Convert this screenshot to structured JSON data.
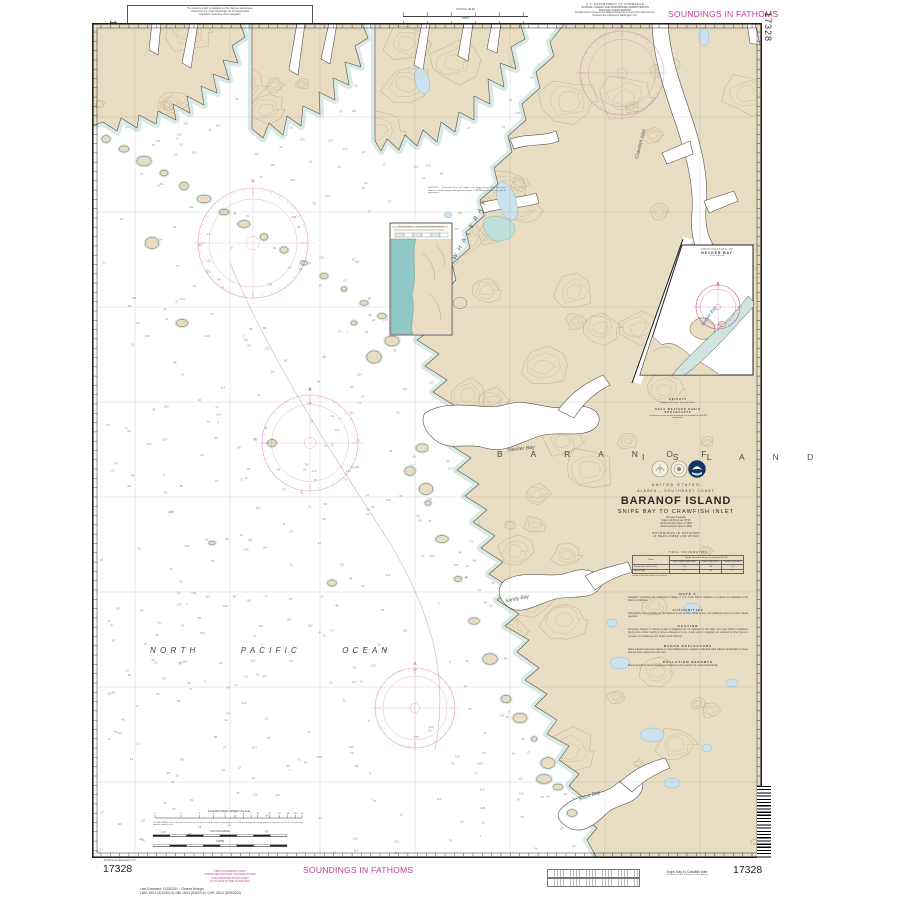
{
  "colors": {
    "magenta": "#c13e8e",
    "land": "#e8dcc2",
    "contour": "#ad9467",
    "shallow": "#d7e8e4",
    "lake": "#c9e2ee",
    "teal": "#8fc8c5",
    "sounding": "#6b7f8c"
  },
  "margin": {
    "note1": "The positions of aids to navigation on this chart are approximate.",
    "note2": "Consult the U.S. Coast Guard Light List for supplemental",
    "note3": "information concerning aids to navigation.",
    "auth1": "U.S. DEPARTMENT OF COMMERCE",
    "auth2": "NATIONAL OCEANIC AND ATMOSPHERIC ADMINISTRATION",
    "auth3": "NATIONAL OCEAN SERVICE",
    "auth4": "Compiled from surveys by the National Ocean Service and from other sources.",
    "auth5": "Prepared and published at Washington, D.C.",
    "soundings_top": "SOUNDINGS IN FATHOMS",
    "chart_number_vertical_left": "17328",
    "chart_number_vertical_right": "17328",
    "scale_caption_miles": "NAUTICAL MILES",
    "scale_caption_yards": "YARDS"
  },
  "title_block": {
    "mini_note_1_heading": "HEIGHTS",
    "mini_note_1_body": "Heights in feet above Mean High Water.",
    "mini_note_2_heading": "NOAA WEATHER RADIO BROADCASTS",
    "mini_note_2_body": "Continuous marine weather broadcasts are provided on VHF-FM frequencies.",
    "island_spread_left": "B A R A N O F",
    "island_spread_right": "I S L A N D",
    "country": "UNITED STATES",
    "region": "ALASKA – SOUTHEAST COAST",
    "title": "BARANOF ISLAND",
    "subtitle": "SNIPE BAY TO CRAWFISH INLET",
    "projection_1": "Mercator Projection",
    "projection_2": "Scale 1:40,000 at Lat. 56°40'",
    "projection_3": "North American Datum of 1983",
    "projection_4": "(World Geodetic System 1984)",
    "soundings_1": "SOUNDINGS IN FATHOMS",
    "soundings_2": "AT MEAN LOWER LOW WATER"
  },
  "tide_table": {
    "title": "TIDAL INFORMATION",
    "place_header": "Place",
    "height_header": "Height referred to datum of soundings (MLLW)",
    "sub_1": "Mean Higher High Water",
    "sub_2": "Mean High Water",
    "sub_3": "Mean Low Water",
    "row_1_place": "Sandy Bay (south coast)",
    "row_1_v1": "9.9",
    "row_1_v2": "9.0",
    "row_1_v3": "1.6",
    "row_2_place": "Necker Bay",
    "row_2_v1": "9.7",
    "row_2_v2": "8.9",
    "row_2_v3": "1.5",
    "footnote": "Heights in feet above datum of soundings."
  },
  "notes": {
    "n1h": "NOTE A",
    "n1b": "Navigation regulations are published in Chapter 2, U.S. Coast Pilot 8. Additions or revisions are published in the Notices to Mariners.",
    "n2h": "AUTHORITIES",
    "n2b": "Hydrography and topography by the National Ocean Service, Coast Survey, with additional surveys by other federal agencies.",
    "n3h": "CAUTION",
    "n3b": "Temporary changes or defects in aids to navigation are not indicated on this chart. See Local Notice to Mariners. During some winter months or when endangered by ice, certain aids to navigation are replaced by other types or removed. For details see U.S. Coast Guard Light List.",
    "n4h": "RADAR REFLECTORS",
    "n4b": "Radar reflectors have been placed on many floating aids to navigation. Individual radar reflector identification on these aids has been omitted from this chart.",
    "n5h": "POLLUTION REPORTS",
    "n5b": "Report all spills of oil and hazardous substances to the nearest U.S. Coast Guard facility."
  },
  "inset": {
    "caption_1": "CONTINUATION OF",
    "caption_2": "NECKER BAY",
    "caption_3": "Scale 1:40,000",
    "water_label": "Necker Bay"
  },
  "map": {
    "ocean_word_1": "N O R T H",
    "ocean_word_2": "P A C I F I C",
    "ocean_word_3": "O C E A N",
    "label_whale_bay": "W H A L E   B A Y",
    "label_crawfish": "Crawfish Inlet",
    "label_necker": "Necker Bay",
    "label_sandy": "Sandy Bay",
    "label_snipe": "Snipe Bay",
    "land_note": "CAUTION — Uncharted rocks and ledges exist close inshore along this coast. Mariners should navigate with extreme caution in the vicinity of Whale Bay and its approaches.",
    "panel_note": "Survey coverage — see source classification diagram",
    "speed_scale_title": "LOGARITHMIC SPEED SCALE",
    "speed_scale_note": "TO FIND SPEED: Place one point of dividers on minutes run and the other on the distance run; without changing the spread, place the right point on 60; the left point then indicates speed in knots."
  },
  "bottom": {
    "pub_note": "Published at Washington, D.C.",
    "chart_number_left": "17328",
    "correction_line_1": "Last Corrected: 11/23/2011 · Cleared through",
    "correction_line_2": "LNM: 16/14 (4/22/2014), NM: 16/14 (5/3/2014), CHS: 03/14 (3/28/2014)",
    "stamp_line_1": "PRINT-ON-DEMAND CHART",
    "stamp_line_2": "CORRECTED THROUGH THE DATES SHOWN",
    "stamp_line_3": "NOAA CERTIFIED CHART AGENT",
    "stamp_line_4": "UP-TO-DATE AT TIME OF PRINTING",
    "soundings_bottom": "SOUNDINGS IN FATHOMS",
    "title_small": "Snipe Bay to Crawfish Inlet",
    "subtitle_small": "Southwest Coast of Baranof Island, Alaska",
    "chart_number_right": "17328"
  }
}
